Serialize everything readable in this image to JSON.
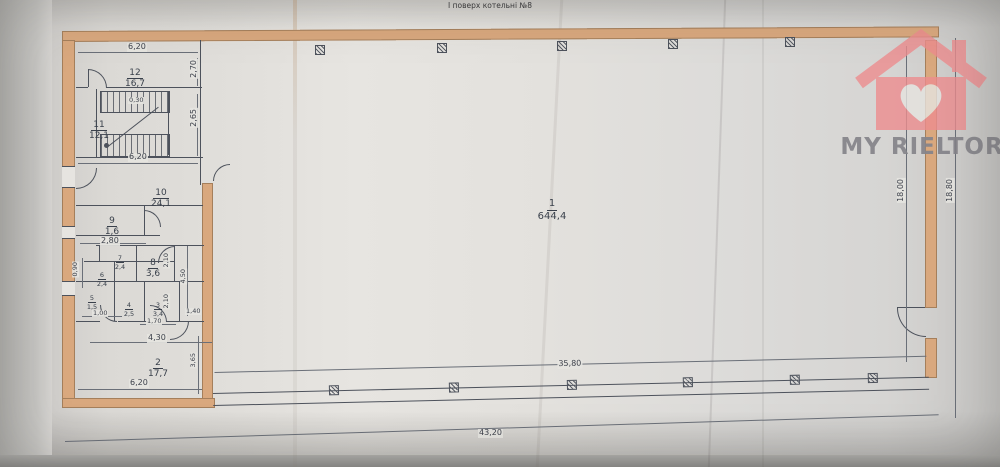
{
  "title": "І поверх котельні №8",
  "watermark": {
    "brand": "MY RIELTOR"
  },
  "colors": {
    "wall_fill": "#d9a87e",
    "drawing_line": "#4d525c",
    "logo_pink": "#ed8d8f",
    "logo_text_gray": "#85848a",
    "paper": "#e3e1dd"
  },
  "rooms": {
    "r1": {
      "num": "1",
      "area": "644,4"
    },
    "r2": {
      "num": "2",
      "area": "17,7"
    },
    "r3": {
      "num": "3",
      "area": "3,4"
    },
    "r4": {
      "num": "4",
      "area": "2,5"
    },
    "r5": {
      "num": "5",
      "area": "1,5"
    },
    "r6": {
      "num": "6",
      "area": "2,4"
    },
    "r7": {
      "num": "7",
      "area": "2,4"
    },
    "r8": {
      "num": "8",
      "area": "3,6"
    },
    "r9": {
      "num": "9",
      "area": "1,6"
    },
    "r10": {
      "num": "10",
      "area": "24,1"
    },
    "r11": {
      "num": "11",
      "area": "12,1"
    },
    "r12": {
      "num": "12",
      "area": "16,7"
    }
  },
  "dims": {
    "top_620": "6,20",
    "mid_620": "6,20",
    "bot_620": "6,20",
    "v270": "2,70",
    "v265": "2,65",
    "v090": "0,90",
    "v450": "4,50",
    "v210a": "2,10",
    "v210b": "2,10",
    "v365": "3,65",
    "h280": "2,80",
    "h100": "1,00",
    "h170": "1,70",
    "h140": "1,40",
    "h430": "4,30",
    "s030": "0,30",
    "hall_3580": "35,80",
    "total_4320": "43,20",
    "r1800": "18,00",
    "r1880": "18,80"
  }
}
